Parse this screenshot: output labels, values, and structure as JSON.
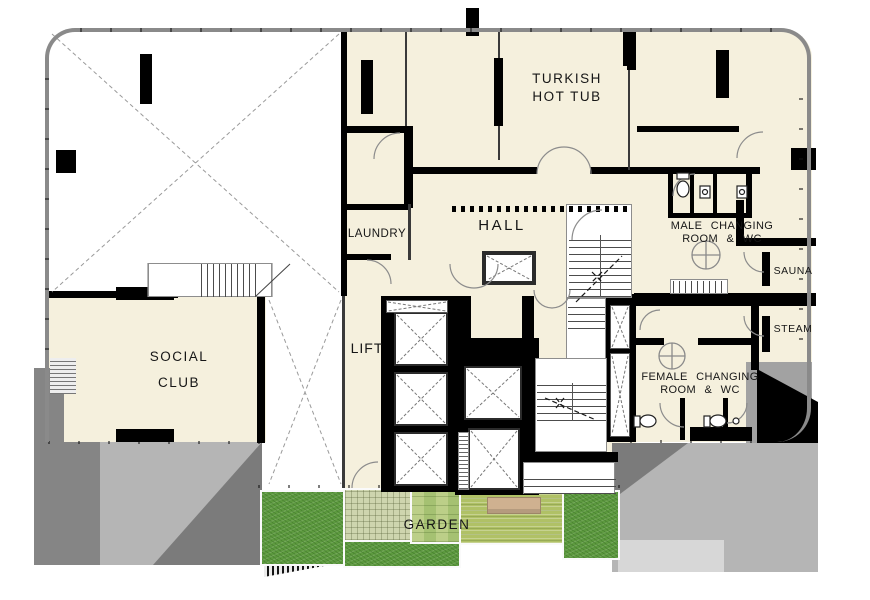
{
  "plan_title": "spa-level floor plan",
  "colors": {
    "floor-cream": "#f5f0dd",
    "wall-black": "#000000",
    "outline-gray": "#8a8a8a",
    "void-dash": "#9a9a9a",
    "plaza-light": "#b5b5b5",
    "plaza-dark": "#7b7b7b",
    "plaza-strip": "#858585",
    "plaza-tile": "#d7d7d7",
    "grass-green": "#5d9a3f",
    "paving-green": "#ced5ae",
    "steps-green": "#bccf88",
    "deck-green": "#b0c166",
    "bench-tan": "#cfb190",
    "label-ink": "#161616"
  },
  "labels": {
    "turkish": {
      "line1": "TURKISH",
      "line2": "HOT TUB"
    },
    "hall": {
      "line1": "HALL"
    },
    "laundry": {
      "line1": "LAUNDRY"
    },
    "lift": {
      "line1": "LIFT"
    },
    "social": {
      "line1": "SOCIAL",
      "line2": "CLUB"
    },
    "male": {
      "line1": "MALE CHANGING",
      "line2": "ROOM & WC"
    },
    "sauna": {
      "line1": "SAUNA"
    },
    "steam": {
      "line1": "STEAM"
    },
    "female": {
      "line1": "FEMALE CHANGING",
      "line2": "ROOM & WC"
    },
    "garden": {
      "line1": "GARDEN"
    }
  }
}
